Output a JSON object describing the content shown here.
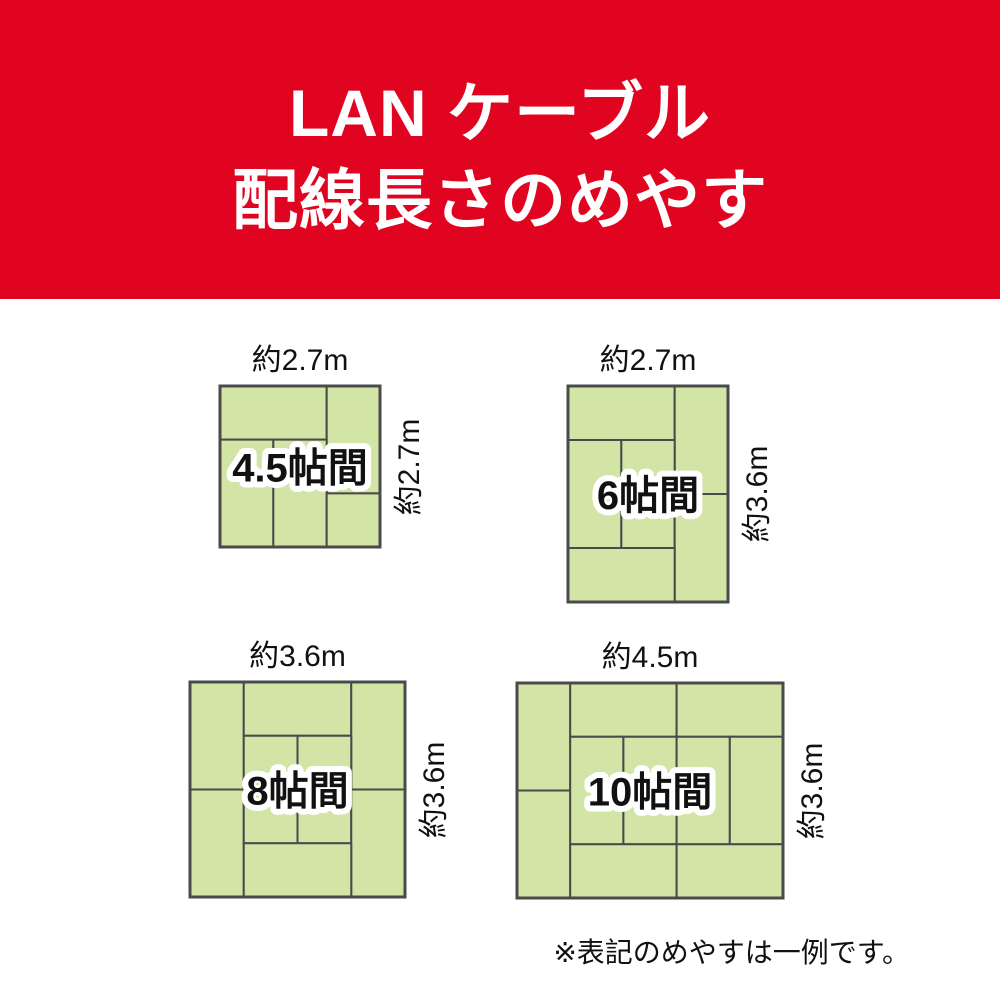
{
  "header": {
    "title_line1": "LAN ケーブル",
    "title_line2": "配線長さのめやす"
  },
  "colors": {
    "header_bg": "#e00420",
    "header_text": "#ffffff",
    "tatami_fill": "#d3e5a6",
    "tatami_border": "#4a4a4a",
    "text": "#111111",
    "label_outline": "#ffffff"
  },
  "rooms": [
    {
      "name": "4.5帖間",
      "width_label": "約2.7m",
      "height_label": "約2.7m",
      "width_m": 2.7,
      "height_m": 2.7,
      "grid": {
        "cols": 3,
        "rows": 3
      },
      "box": {
        "left": 220,
        "top": 386,
        "width": 160,
        "height": 161
      },
      "mats": [
        [
          0,
          0,
          2,
          1
        ],
        [
          2,
          0,
          1,
          2
        ],
        [
          0,
          1,
          1,
          2
        ],
        [
          1,
          1,
          1,
          2
        ],
        [
          2,
          2,
          1,
          1
        ]
      ]
    },
    {
      "name": "6帖間",
      "width_label": "約2.7m",
      "height_label": "約3.6m",
      "width_m": 2.7,
      "height_m": 3.6,
      "grid": {
        "cols": 3,
        "rows": 4
      },
      "box": {
        "left": 568,
        "top": 386,
        "width": 160,
        "height": 216
      },
      "mats": [
        [
          0,
          0,
          2,
          1
        ],
        [
          2,
          0,
          1,
          2
        ],
        [
          0,
          1,
          1,
          2
        ],
        [
          1,
          1,
          1,
          2
        ],
        [
          2,
          2,
          1,
          2
        ],
        [
          0,
          3,
          2,
          1
        ]
      ]
    },
    {
      "name": "8帖間",
      "width_label": "約3.6m",
      "height_label": "約3.6m",
      "width_m": 3.6,
      "height_m": 3.6,
      "grid": {
        "cols": 4,
        "rows": 4
      },
      "box": {
        "left": 190,
        "top": 682,
        "width": 215,
        "height": 215
      },
      "mats": [
        [
          0,
          0,
          1,
          2
        ],
        [
          1,
          0,
          2,
          1
        ],
        [
          3,
          0,
          1,
          2
        ],
        [
          0,
          2,
          1,
          2
        ],
        [
          1,
          1,
          1,
          2
        ],
        [
          2,
          1,
          1,
          2
        ],
        [
          3,
          2,
          1,
          2
        ],
        [
          1,
          3,
          2,
          1
        ]
      ]
    },
    {
      "name": "10帖間",
      "width_label": "約4.5m",
      "height_label": "約3.6m",
      "width_m": 4.5,
      "height_m": 3.6,
      "grid": {
        "cols": 5,
        "rows": 4
      },
      "box": {
        "left": 517,
        "top": 683,
        "width": 266,
        "height": 215
      },
      "mats": [
        [
          0,
          0,
          1,
          2
        ],
        [
          1,
          0,
          2,
          1
        ],
        [
          3,
          0,
          2,
          1
        ],
        [
          0,
          2,
          1,
          2
        ],
        [
          1,
          1,
          1,
          2
        ],
        [
          2,
          1,
          1,
          2
        ],
        [
          3,
          1,
          1,
          2
        ],
        [
          4,
          1,
          1,
          2
        ],
        [
          1,
          3,
          2,
          1
        ],
        [
          3,
          3,
          2,
          1
        ]
      ]
    }
  ],
  "footnote": "※表記のめやすは一例です。"
}
